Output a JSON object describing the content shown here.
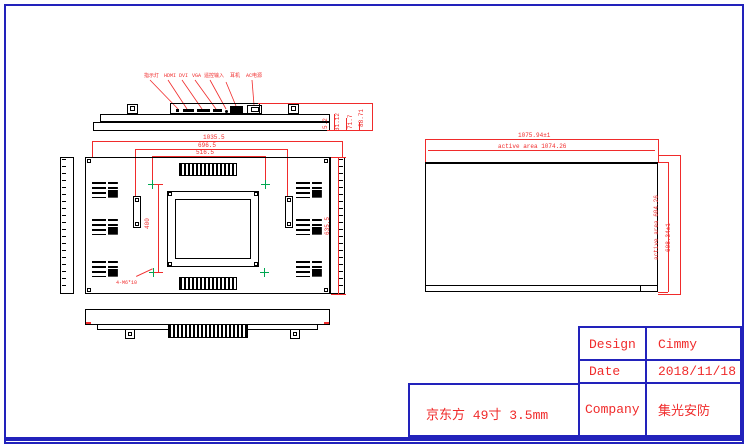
{
  "colors": {
    "line": "#000000",
    "dim": "#f02b2b",
    "border": "#2222bb",
    "marker": "#00a651",
    "bg": "#ffffff"
  },
  "top_view": {
    "connector_labels": [
      "指示灯",
      "HDMI",
      "DVI",
      "VGA",
      "遥控输入",
      "耳机",
      "AC电源"
    ],
    "depth_dims": [
      "5.2",
      "31.12",
      "71.7",
      "88.71"
    ]
  },
  "back_view": {
    "dim_width_outer": "1035.5",
    "dim_width_mid": "696.5",
    "dim_width_vesa": "516.5",
    "dim_height_vesa": "400",
    "dim_height_outer": "635.5",
    "hole_callout": "4-M6*10"
  },
  "front_view": {
    "dim_width_outer": "1075.94±1",
    "dim_width_active": "active area 1074.26",
    "dim_height_active": "active area 604.26",
    "dim_height_outer": "608.34±1"
  },
  "label_box": {
    "text": "京东方 49寸 3.5mm"
  },
  "title_block": {
    "design_label": "Design",
    "design_value": "Cimmy",
    "date_label": "Date",
    "date_value": "2018/11/18",
    "company_label": "Company",
    "company_value": "集光安防"
  }
}
